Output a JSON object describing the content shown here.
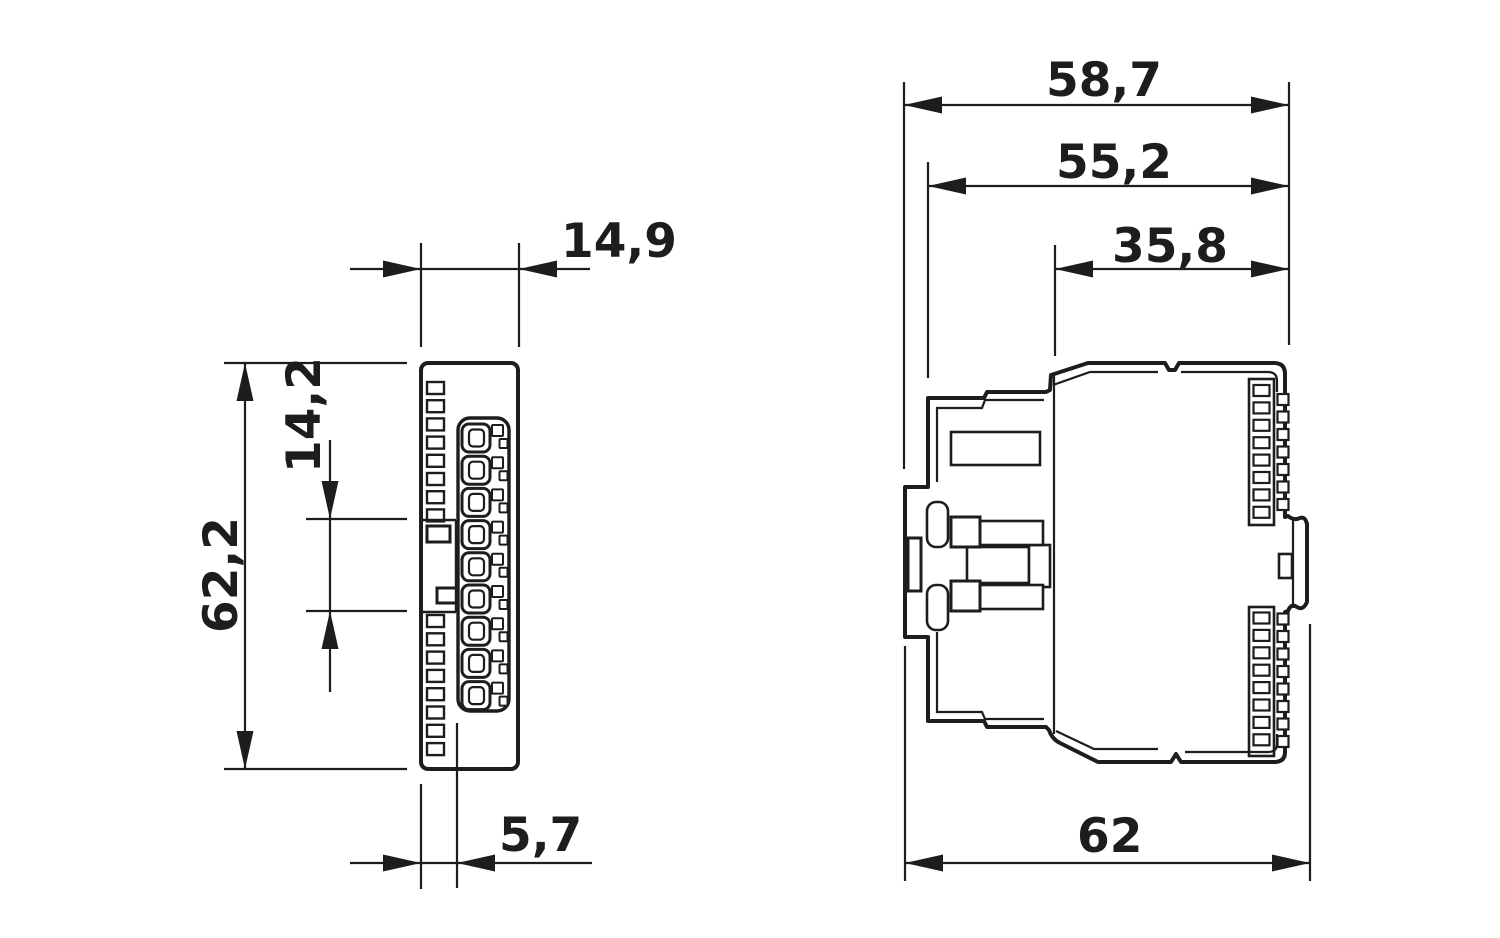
{
  "drawing": {
    "type": "technical-dimension-drawing",
    "views": {
      "front_view": {
        "name": "front view (DIN rail module, terminal side)",
        "dimensions": {
          "width": "14,9",
          "height": "62,2",
          "terminal_pitch": "14,2",
          "offset": "5,7"
        }
      },
      "side_view": {
        "name": "side view (DIN rail module)",
        "dimensions": {
          "total_depth": "58,7",
          "housing_depth": "55,2",
          "front_depth": "35,8",
          "overall_depth": "62"
        }
      }
    },
    "colors": {
      "line": "#1d1d1b",
      "background": "#ffffff"
    }
  }
}
